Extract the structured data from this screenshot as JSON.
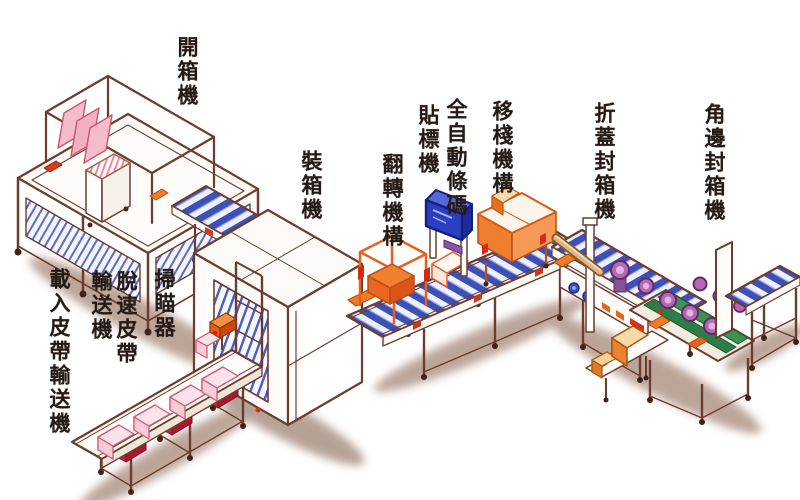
{
  "canvas": {
    "width": 800,
    "height": 500,
    "background": "#ffffff"
  },
  "palette": {
    "outline": "#6e3c2c",
    "label_text": "#241a16",
    "conveyor_blue": "#3c50b8",
    "hatch_blue": "#5b6cc8",
    "accent_orange": "#ef7a28",
    "accent_red": "#d43318",
    "carton_pink": "#f5bcca",
    "machine_purple": "#b468b6",
    "belt_green": "#2e7d46",
    "screen_blue": "#2b3fc0",
    "shadow_brown": "#8a5f46"
  },
  "machines": [
    {
      "id": "case-erector",
      "label": "開箱機"
    },
    {
      "id": "case-packer",
      "label": "裝箱機"
    },
    {
      "id": "flip-mechanism",
      "label": "翻轉機構"
    },
    {
      "id": "auto-barcode-labeler",
      "label": "全自動條碼貼標機",
      "label_columns": [
        "全自動條碼",
        "貼標機"
      ]
    },
    {
      "id": "pallet-transfer-mechanism",
      "label": "移棧機構"
    },
    {
      "id": "flap-fold-carton-sealer",
      "label": "折蓋封箱機"
    },
    {
      "id": "corner-edge-carton-sealer",
      "label": "角邊封箱機"
    },
    {
      "id": "scanner",
      "label": "掃瞄器"
    },
    {
      "id": "speed-release-belt-conveyor",
      "label": "脫速皮帶輸送機",
      "label_columns": [
        "脫速皮帶",
        "輸送機"
      ]
    },
    {
      "id": "infeed-belt-conveyor",
      "label": "載入皮帶輸送機"
    }
  ]
}
